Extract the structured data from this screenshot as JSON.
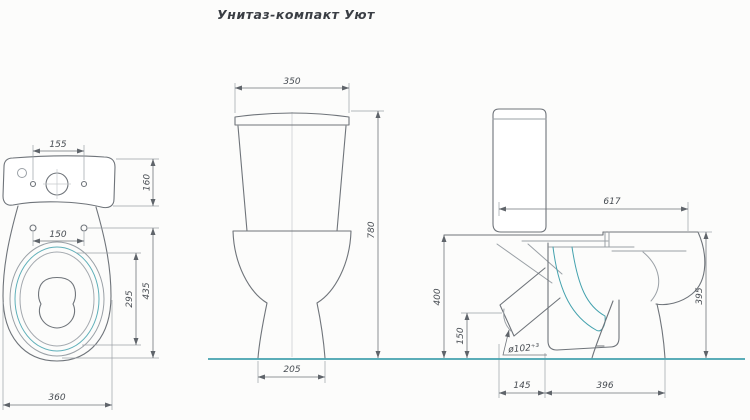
{
  "title": "Унитаз-компакт Уют",
  "colors": {
    "line": "#9aa0a6",
    "dark": "#6f747a",
    "teal": "#44a2ae",
    "text": "#474c52",
    "bg": "#fcfcfb"
  },
  "top_view": {
    "dim_tank_holes": "155",
    "dim_tank_depth": "160",
    "dim_seat_holes": "150",
    "dim_opening_length": "295",
    "dim_bowl_length": "435",
    "dim_width": "360"
  },
  "front_view": {
    "dim_tank_width": "350",
    "dim_height": "780",
    "dim_base": "205"
  },
  "side_view": {
    "dim_depth": "617",
    "dim_seat_height": "400",
    "dim_outlet_axis_height": "150",
    "dim_bowl_height": "395",
    "dim_outlet_offset": "145",
    "dim_base_depth": "396",
    "outlet_diameter": "ø102⁺³"
  }
}
